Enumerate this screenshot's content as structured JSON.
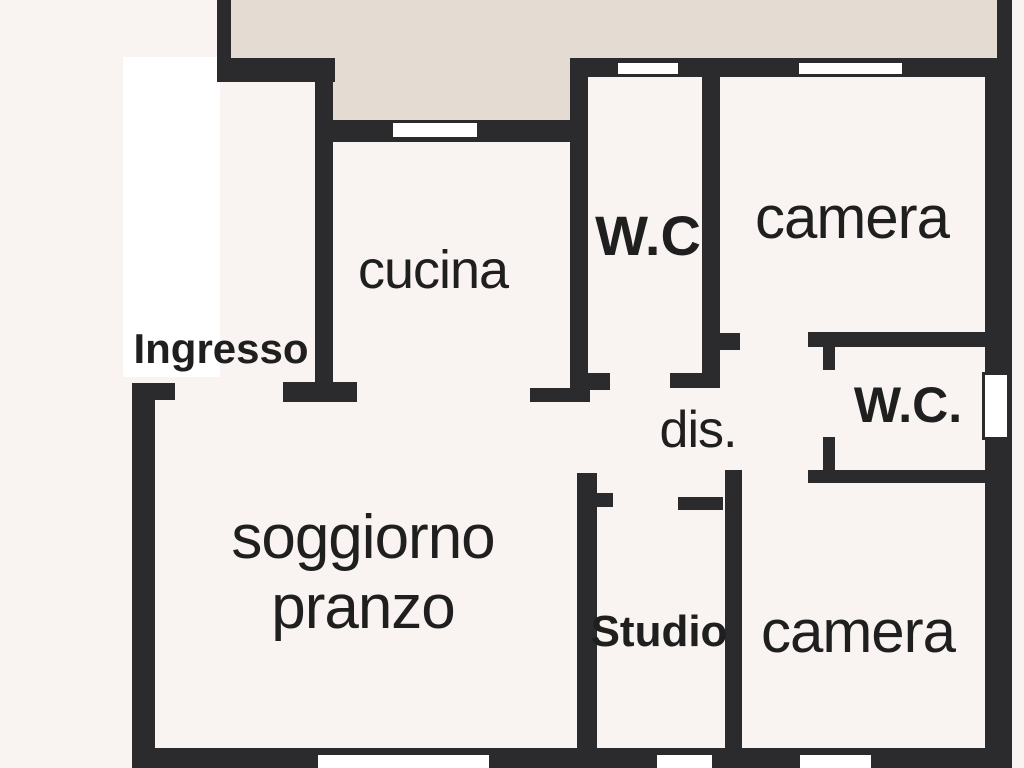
{
  "canvas": {
    "width": 1024,
    "height": 768
  },
  "colors": {
    "background": "#f9f4f1",
    "wall": "#2b2b2e",
    "terrace": "#e4dcd2",
    "room_white": "#ffffff",
    "window_fill": "#ffffff",
    "text": "#1f1f1f"
  },
  "regions": [
    {
      "name": "terrace-area-left",
      "x": 231,
      "y": 0,
      "w": 104,
      "h": 62,
      "fill": "terrace"
    },
    {
      "name": "terrace-area-mid",
      "x": 333,
      "y": 0,
      "w": 252,
      "h": 122,
      "fill": "terrace"
    },
    {
      "name": "terrace-area-right",
      "x": 585,
      "y": 0,
      "w": 412,
      "h": 60,
      "fill": "terrace"
    },
    {
      "name": "ingresso-floor",
      "x": 123,
      "y": 57,
      "w": 97,
      "h": 320,
      "fill": "room_white"
    }
  ],
  "walls": [
    {
      "name": "terrace-left-wall",
      "x": 217,
      "y": 0,
      "w": 14,
      "h": 60
    },
    {
      "name": "cucina-top-wall",
      "x": 217,
      "y": 58,
      "w": 118,
      "h": 24
    },
    {
      "name": "cucina-left-wall",
      "x": 315,
      "y": 82,
      "w": 18,
      "h": 320
    },
    {
      "name": "terrace-bottom-wall",
      "x": 333,
      "y": 120,
      "w": 252,
      "h": 22
    },
    {
      "name": "top-exterior-wall",
      "x": 585,
      "y": 58,
      "w": 427,
      "h": 19
    },
    {
      "name": "right-wall-upper",
      "x": 997,
      "y": 0,
      "w": 15,
      "h": 60
    },
    {
      "name": "right-exterior-wall",
      "x": 985,
      "y": 58,
      "w": 27,
      "h": 710
    },
    {
      "name": "cucina-wc-divider-wall",
      "x": 570,
      "y": 58,
      "w": 18,
      "h": 335
    },
    {
      "name": "wc-door-stub",
      "x": 588,
      "y": 373,
      "w": 22,
      "h": 17
    },
    {
      "name": "wc-bottom-wall",
      "x": 670,
      "y": 373,
      "w": 50,
      "h": 15
    },
    {
      "name": "wc-camera-divider-wall",
      "x": 702,
      "y": 77,
      "w": 18,
      "h": 311
    },
    {
      "name": "camera-door-stub",
      "x": 720,
      "y": 333,
      "w": 20,
      "h": 17
    },
    {
      "name": "wc2-top-wall",
      "x": 808,
      "y": 332,
      "w": 180,
      "h": 15
    },
    {
      "name": "wc2-door-stub-top",
      "x": 823,
      "y": 347,
      "w": 12,
      "h": 23
    },
    {
      "name": "wc2-door-stub-bottom",
      "x": 823,
      "y": 437,
      "w": 12,
      "h": 33
    },
    {
      "name": "camera2-top-wall",
      "x": 808,
      "y": 470,
      "w": 180,
      "h": 13
    },
    {
      "name": "camera2-left-wall",
      "x": 725,
      "y": 470,
      "w": 17,
      "h": 298
    },
    {
      "name": "studio-top-stub",
      "x": 678,
      "y": 497,
      "w": 45,
      "h": 13
    },
    {
      "name": "studio-left-wall",
      "x": 577,
      "y": 473,
      "w": 20,
      "h": 295
    },
    {
      "name": "studio-door-stub",
      "x": 595,
      "y": 493,
      "w": 18,
      "h": 14
    },
    {
      "name": "entry-door-stub",
      "x": 132,
      "y": 383,
      "w": 43,
      "h": 17
    },
    {
      "name": "left-exterior-wall",
      "x": 132,
      "y": 383,
      "w": 23,
      "h": 385
    },
    {
      "name": "soggiorno-top-stub-left",
      "x": 283,
      "y": 382,
      "w": 74,
      "h": 20
    },
    {
      "name": "soggiorno-top-stub-right",
      "x": 530,
      "y": 388,
      "w": 60,
      "h": 14
    },
    {
      "name": "bottom-exterior-wall",
      "x": 132,
      "y": 748,
      "w": 880,
      "h": 20
    }
  ],
  "windows": [
    {
      "name": "cucina-window",
      "x": 393,
      "y": 123,
      "w": 84,
      "h": 14,
      "border": false
    },
    {
      "name": "wc-top-window",
      "x": 618,
      "y": 63,
      "w": 60,
      "h": 11,
      "border": false
    },
    {
      "name": "camera-top-window",
      "x": 799,
      "y": 63,
      "w": 103,
      "h": 11,
      "border": false
    },
    {
      "name": "wc-right-window",
      "x": 982,
      "y": 372,
      "w": 28,
      "h": 68,
      "border": true
    },
    {
      "name": "soggiorno-window",
      "x": 318,
      "y": 755,
      "w": 171,
      "h": 13,
      "border": false
    },
    {
      "name": "studio-window",
      "x": 657,
      "y": 755,
      "w": 55,
      "h": 13,
      "border": false
    },
    {
      "name": "camera-bottom-window",
      "x": 800,
      "y": 755,
      "w": 71,
      "h": 13,
      "border": false
    }
  ],
  "rooms": [
    {
      "id": "ingresso",
      "label": "Ingresso",
      "cx": 221,
      "cy": 349,
      "size": 42,
      "weight": 700,
      "ls": 0
    },
    {
      "id": "cucina",
      "label": "cucina",
      "cx": 433,
      "cy": 270,
      "size": 54,
      "weight": 500,
      "ls": -1
    },
    {
      "id": "wc-top",
      "label": "W.C",
      "cx": 648,
      "cy": 236,
      "size": 56,
      "weight": 700,
      "ls": 0
    },
    {
      "id": "camera-top",
      "label": "camera",
      "cx": 852,
      "cy": 218,
      "size": 60,
      "weight": 500,
      "ls": -1
    },
    {
      "id": "dis",
      "label": "dis.",
      "cx": 698,
      "cy": 430,
      "size": 52,
      "weight": 500,
      "ls": -1
    },
    {
      "id": "wc-right",
      "label": "W.C.",
      "cx": 908,
      "cy": 405,
      "size": 50,
      "weight": 700,
      "ls": 0
    },
    {
      "id": "soggiorno-line1",
      "label": "soggiorno",
      "cx": 363,
      "cy": 538,
      "size": 62,
      "weight": 500,
      "ls": -1
    },
    {
      "id": "soggiorno-line2",
      "label": "pranzo",
      "cx": 363,
      "cy": 608,
      "size": 62,
      "weight": 500,
      "ls": -1
    },
    {
      "id": "studio",
      "label": "Studio",
      "cx": 659,
      "cy": 632,
      "size": 44,
      "weight": 700,
      "ls": 0
    },
    {
      "id": "camera-bottom",
      "label": "camera",
      "cx": 858,
      "cy": 632,
      "size": 60,
      "weight": 500,
      "ls": -1
    }
  ]
}
